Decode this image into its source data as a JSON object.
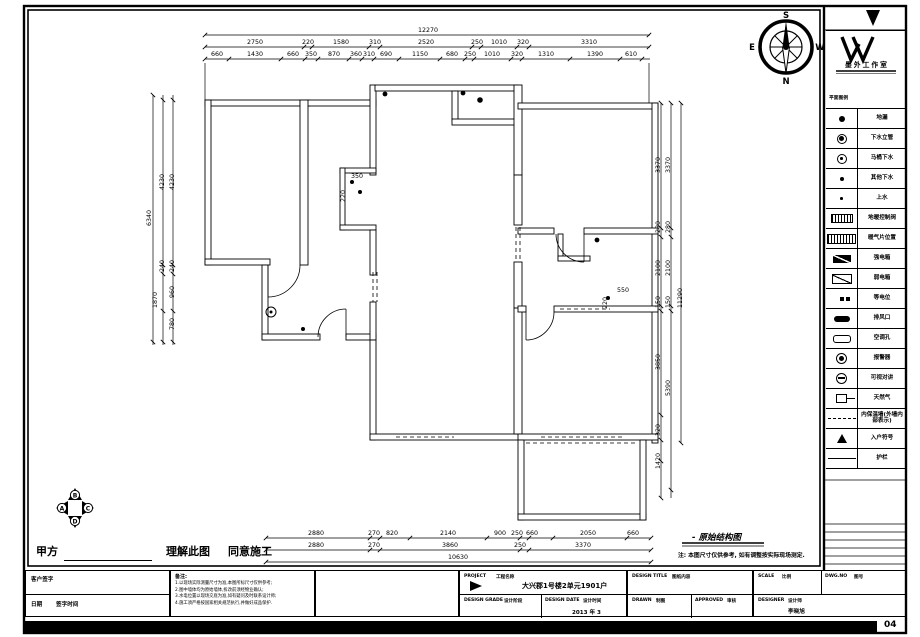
{
  "sheet": {
    "page_no": "04"
  },
  "compass": {
    "n": "N",
    "s": "S",
    "e": "E",
    "w": "W"
  },
  "markers": [
    "A",
    "B",
    "C",
    "D"
  ],
  "stamp": {
    "party_label": "甲方",
    "understand": "理解此图",
    "agree": "同意施工"
  },
  "plan_caption": {
    "title": "- 原始结构图",
    "note": "注: 本图尺寸仅供参考, 如有调整按实际现场测定."
  },
  "legend": {
    "explanation": "EXPLANATION",
    "title": "图例说明",
    "studio": "墨外工作室",
    "section_label": "平面图例",
    "items": [
      {
        "icon": "floor-drain",
        "label": "地漏"
      },
      {
        "icon": "sewer-standpipe",
        "label": "下水立管"
      },
      {
        "icon": "toilet-drain",
        "label": "马桶下水"
      },
      {
        "icon": "other-drain",
        "label": "其他下水"
      },
      {
        "icon": "water-supply",
        "label": "上水"
      },
      {
        "icon": "heating-valve",
        "label": "地暖控制阀"
      },
      {
        "icon": "radiator",
        "label": "暖气片位置"
      },
      {
        "icon": "strong-elec-box",
        "label": "强电箱"
      },
      {
        "icon": "weak-elec-box",
        "label": "弱电箱"
      },
      {
        "icon": "equipotential",
        "label": "等电位"
      },
      {
        "icon": "exhaust-vent",
        "label": "排风口"
      },
      {
        "icon": "ac-hole",
        "label": "空调孔"
      },
      {
        "icon": "alarm",
        "label": "报警器"
      },
      {
        "icon": "video-intercom",
        "label": "可视对讲"
      },
      {
        "icon": "natural-gas",
        "label": "天然气"
      },
      {
        "icon": "insulation-wall",
        "label": "内保温墙(外墙内部表示)"
      },
      {
        "icon": "entry-symbol",
        "label": "入户符号"
      },
      {
        "icon": "railing",
        "label": "护栏"
      }
    ]
  },
  "titleblock": {
    "client_sign_label": "客户签字",
    "sign_date_label": "日期",
    "sign_date_note": "签字时间",
    "remark_label": "备注:",
    "remark_lines": [
      "1.以现场实际测量尺寸为准,本图所标尺寸仅供参考;",
      "2.图中墙体均为原始墙体,拆改前须经物业确认;",
      "3.水电位置以现场交底为准,如有疑问及时联系设计师;",
      "4.施工须严格按国家相关规范执行,并做好成品保护."
    ],
    "project_label": "PROJECT",
    "project_cn": "工程名称",
    "project_value": "大兴郡1号楼2单元1901户",
    "design_grade_label": "DESIGN GRADE",
    "design_grade_cn": "设计阶段",
    "design_date_label": "DESIGN DATE",
    "design_date_cn": "设计时间",
    "design_date_value": "2013 年 3",
    "design_title_label": "DESIGN TITLE",
    "design_title_cn": "图纸内容",
    "drawn_label": "DRAWN",
    "drawn_cn": "制图",
    "approved_label": "APPROVED",
    "approved_cn": "审核",
    "scale_label": "SCALE",
    "scale_cn": "比例",
    "dwg_label": "DWG.NO",
    "dwg_cn": "图号",
    "designer_label": "DESIGNER",
    "designer_cn": "设计师",
    "designer_value": "李晓旭"
  },
  "dims": [
    {
      "t": "12270",
      "x": 428,
      "y": 31
    },
    {
      "t": "2750",
      "x": 255,
      "y": 43
    },
    {
      "t": "220",
      "x": 308,
      "y": 43
    },
    {
      "t": "1580",
      "x": 341,
      "y": 43
    },
    {
      "t": "310",
      "x": 375,
      "y": 43
    },
    {
      "t": "2520",
      "x": 426,
      "y": 43
    },
    {
      "t": "250",
      "x": 477,
      "y": 43
    },
    {
      "t": "1010",
      "x": 499,
      "y": 43
    },
    {
      "t": "320",
      "x": 523,
      "y": 43
    },
    {
      "t": "3310",
      "x": 589,
      "y": 43
    },
    {
      "t": "660",
      "x": 217,
      "y": 55
    },
    {
      "t": "1430",
      "x": 255,
      "y": 55
    },
    {
      "t": "660",
      "x": 293,
      "y": 55
    },
    {
      "t": "350",
      "x": 311,
      "y": 55
    },
    {
      "t": "870",
      "x": 334,
      "y": 55
    },
    {
      "t": "360",
      "x": 356,
      "y": 55
    },
    {
      "t": "310",
      "x": 369,
      "y": 55
    },
    {
      "t": "690",
      "x": 386,
      "y": 55
    },
    {
      "t": "1150",
      "x": 420,
      "y": 55
    },
    {
      "t": "680",
      "x": 452,
      "y": 55
    },
    {
      "t": "250",
      "x": 470,
      "y": 55
    },
    {
      "t": "1010",
      "x": 492,
      "y": 55
    },
    {
      "t": "320",
      "x": 517,
      "y": 55
    },
    {
      "t": "1310",
      "x": 546,
      "y": 55
    },
    {
      "t": "1390",
      "x": 595,
      "y": 55
    },
    {
      "t": "610",
      "x": 631,
      "y": 55
    },
    {
      "t": "2880",
      "x": 316,
      "y": 534
    },
    {
      "t": "270",
      "x": 374,
      "y": 534
    },
    {
      "t": "820",
      "x": 392,
      "y": 534
    },
    {
      "t": "2140",
      "x": 448,
      "y": 534
    },
    {
      "t": "900",
      "x": 500,
      "y": 534
    },
    {
      "t": "250",
      "x": 517,
      "y": 534
    },
    {
      "t": "660",
      "x": 532,
      "y": 534
    },
    {
      "t": "2050",
      "x": 588,
      "y": 534
    },
    {
      "t": "660",
      "x": 633,
      "y": 534
    },
    {
      "t": "2880",
      "x": 316,
      "y": 546
    },
    {
      "t": "270",
      "x": 374,
      "y": 546
    },
    {
      "t": "3860",
      "x": 450,
      "y": 546
    },
    {
      "t": "250",
      "x": 520,
      "y": 546
    },
    {
      "t": "3370",
      "x": 583,
      "y": 546
    },
    {
      "t": "10630",
      "x": 458,
      "y": 558
    },
    {
      "t": "6340",
      "x": 150,
      "y": 218,
      "r": 1
    },
    {
      "t": "4230",
      "x": 163,
      "y": 182,
      "r": 1
    },
    {
      "t": "4230",
      "x": 173,
      "y": 182,
      "r": 1
    },
    {
      "t": "240",
      "x": 163,
      "y": 266,
      "r": 1
    },
    {
      "t": "240",
      "x": 173,
      "y": 266,
      "r": 1
    },
    {
      "t": "1870",
      "x": 156,
      "y": 300,
      "r": 1
    },
    {
      "t": "960",
      "x": 173,
      "y": 292,
      "r": 1
    },
    {
      "t": "780",
      "x": 173,
      "y": 324,
      "r": 1
    },
    {
      "t": "3370",
      "x": 659,
      "y": 165,
      "r": 1
    },
    {
      "t": "3370",
      "x": 669,
      "y": 165,
      "r": 1
    },
    {
      "t": "280",
      "x": 659,
      "y": 227,
      "r": 1
    },
    {
      "t": "280",
      "x": 669,
      "y": 227,
      "r": 1
    },
    {
      "t": "2100",
      "x": 659,
      "y": 268,
      "r": 1
    },
    {
      "t": "2100",
      "x": 669,
      "y": 268,
      "r": 1
    },
    {
      "t": "150",
      "x": 659,
      "y": 302,
      "r": 1
    },
    {
      "t": "150",
      "x": 669,
      "y": 302,
      "r": 1
    },
    {
      "t": "3850",
      "x": 659,
      "y": 362,
      "r": 1
    },
    {
      "t": "5390",
      "x": 669,
      "y": 388,
      "r": 1
    },
    {
      "t": "11290",
      "x": 681,
      "y": 298,
      "r": 1
    },
    {
      "t": "320",
      "x": 659,
      "y": 430,
      "r": 1
    },
    {
      "t": "1420",
      "x": 659,
      "y": 461,
      "r": 1
    },
    {
      "t": "350",
      "x": 357,
      "y": 177
    },
    {
      "t": "220",
      "x": 344,
      "y": 196,
      "r": 1
    },
    {
      "t": "550",
      "x": 623,
      "y": 291
    },
    {
      "t": "220",
      "x": 606,
      "y": 303,
      "r": 1
    }
  ]
}
